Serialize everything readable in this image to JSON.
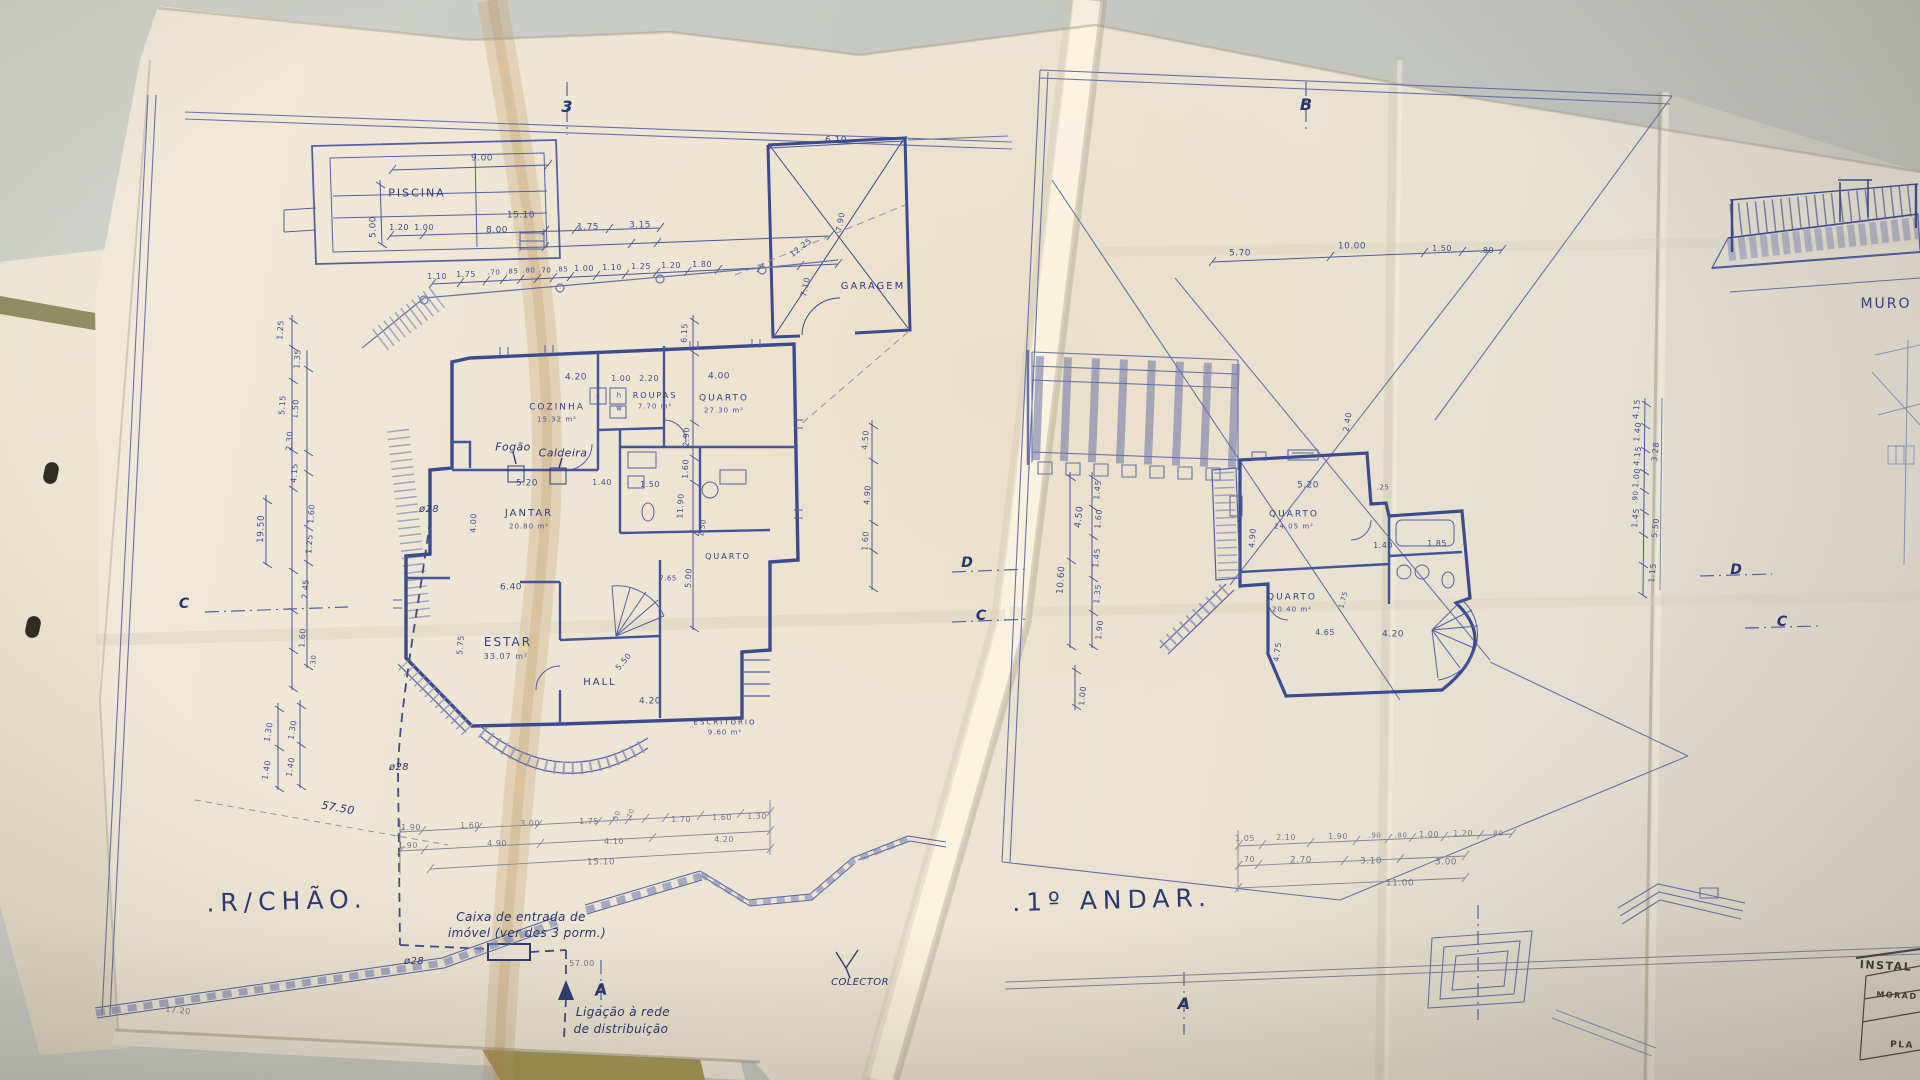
{
  "scene": {
    "desk_color": "#c7c9c4",
    "paper_color": "#ece4d4",
    "ink_color": "#3c4a8e",
    "fold_tint": "#c79a60",
    "folder_color": "#8e8e62"
  },
  "titles": {
    "ground_floor": ".R/CHÃO.",
    "first_floor": ".1º ANDAR."
  },
  "labels": [
    {
      "t": "PISCINA",
      "x": 417,
      "y": 193,
      "s": 11,
      "k": "rm"
    },
    {
      "t": "9.00",
      "x": 482,
      "y": 159,
      "s": 9,
      "k": "d"
    },
    {
      "t": "5.00",
      "x": 374,
      "y": 227,
      "s": 9,
      "k": "d",
      "r": -90
    },
    {
      "t": "1.20",
      "x": 399,
      "y": 228,
      "s": 8,
      "k": "d"
    },
    {
      "t": "1.00",
      "x": 424,
      "y": 228,
      "s": 8,
      "k": "d"
    },
    {
      "t": "15.10",
      "x": 521,
      "y": 216,
      "s": 9,
      "k": "d"
    },
    {
      "t": "8.00",
      "x": 497,
      "y": 231,
      "s": 9,
      "k": "d"
    },
    {
      "t": "1.75",
      "x": 588,
      "y": 228,
      "s": 9,
      "k": "d"
    },
    {
      "t": "3.15",
      "x": 640,
      "y": 226,
      "s": 9,
      "k": "d"
    },
    {
      "t": "1.10",
      "x": 437,
      "y": 277,
      "s": 8,
      "k": "d"
    },
    {
      "t": "1.75",
      "x": 466,
      "y": 275,
      "s": 8,
      "k": "d"
    },
    {
      "t": ".70",
      "x": 494,
      "y": 273,
      "s": 7,
      "k": "d"
    },
    {
      "t": ".85",
      "x": 512,
      "y": 272,
      "s": 7,
      "k": "d"
    },
    {
      "t": ".80",
      "x": 529,
      "y": 271,
      "s": 7,
      "k": "d"
    },
    {
      "t": ".70",
      "x": 545,
      "y": 271,
      "s": 7,
      "k": "d"
    },
    {
      "t": ".85",
      "x": 562,
      "y": 270,
      "s": 7,
      "k": "d"
    },
    {
      "t": "1.00",
      "x": 584,
      "y": 269,
      "s": 8,
      "k": "d"
    },
    {
      "t": "1.10",
      "x": 612,
      "y": 268,
      "s": 8,
      "k": "d"
    },
    {
      "t": "1.25",
      "x": 641,
      "y": 267,
      "s": 8,
      "k": "d"
    },
    {
      "t": "1.20",
      "x": 671,
      "y": 266,
      "s": 8,
      "k": "d"
    },
    {
      "t": "1.80",
      "x": 702,
      "y": 265,
      "s": 8,
      "k": "d"
    },
    {
      "t": "6.10",
      "x": 836,
      "y": 141,
      "s": 9,
      "k": "d"
    },
    {
      "t": "GARAGEM",
      "x": 873,
      "y": 287,
      "s": 10,
      "k": "rm"
    },
    {
      "t": "12.25",
      "x": 801,
      "y": 248,
      "s": 8,
      "k": "d",
      "r": -38
    },
    {
      "t": "7.90",
      "x": 841,
      "y": 222,
      "s": 8,
      "k": "d",
      "r": -80
    },
    {
      "t": "7.10",
      "x": 806,
      "y": 287,
      "s": 8,
      "k": "d",
      "r": -78
    },
    {
      "t": "4.20",
      "x": 576,
      "y": 378,
      "s": 9,
      "k": "d"
    },
    {
      "t": "1.00",
      "x": 621,
      "y": 379,
      "s": 8,
      "k": "d"
    },
    {
      "t": "2.20",
      "x": 649,
      "y": 379,
      "s": 8,
      "k": "d"
    },
    {
      "t": "4.00",
      "x": 719,
      "y": 377,
      "s": 9,
      "k": "d"
    },
    {
      "t": "COZINHA",
      "x": 557,
      "y": 408,
      "s": 9,
      "k": "rm"
    },
    {
      "t": "15.32 m²",
      "x": 557,
      "y": 420,
      "s": 7,
      "k": "a"
    },
    {
      "t": "ROUPAS",
      "x": 655,
      "y": 396,
      "s": 8,
      "k": "rm"
    },
    {
      "t": "7.70 m²",
      "x": 655,
      "y": 407,
      "s": 7,
      "k": "a"
    },
    {
      "t": "QUARTO",
      "x": 724,
      "y": 399,
      "s": 9,
      "k": "rm"
    },
    {
      "t": "27.30 m²",
      "x": 724,
      "y": 411,
      "s": 7,
      "k": "a"
    },
    {
      "t": "c",
      "x": 598,
      "y": 397,
      "s": 7,
      "k": "t"
    },
    {
      "t": "h",
      "x": 619,
      "y": 396,
      "s": 7,
      "k": "t"
    },
    {
      "t": "w",
      "x": 619,
      "y": 409,
      "s": 7,
      "k": "t"
    },
    {
      "t": "Fogão",
      "x": 513,
      "y": 447,
      "s": 11,
      "k": "s"
    },
    {
      "t": "Caldeira",
      "x": 563,
      "y": 453,
      "s": 11,
      "k": "s"
    },
    {
      "t": "ø28",
      "x": 429,
      "y": 510,
      "s": 10,
      "k": "s"
    },
    {
      "t": "5.20",
      "x": 527,
      "y": 484,
      "s": 9,
      "k": "d"
    },
    {
      "t": "1.40",
      "x": 602,
      "y": 483,
      "s": 8,
      "k": "d"
    },
    {
      "t": "1.50",
      "x": 650,
      "y": 485,
      "s": 8,
      "k": "d"
    },
    {
      "t": "JANTAR",
      "x": 529,
      "y": 514,
      "s": 10,
      "k": "rm"
    },
    {
      "t": "20.80 m²",
      "x": 529,
      "y": 527,
      "s": 7,
      "k": "a"
    },
    {
      "t": "4.00",
      "x": 474,
      "y": 523,
      "s": 8,
      "k": "d",
      "r": -88
    },
    {
      "t": "6.40",
      "x": 511,
      "y": 588,
      "s": 9,
      "k": "d"
    },
    {
      "t": "ESTAR",
      "x": 508,
      "y": 642,
      "s": 12,
      "k": "rm"
    },
    {
      "t": "33.07 m²",
      "x": 506,
      "y": 657,
      "s": 8,
      "k": "a"
    },
    {
      "t": "5.75",
      "x": 461,
      "y": 645,
      "s": 8,
      "k": "d",
      "r": -85
    },
    {
      "t": "HALL",
      "x": 600,
      "y": 683,
      "s": 10,
      "k": "rm"
    },
    {
      "t": "5.50",
      "x": 624,
      "y": 662,
      "s": 8,
      "k": "d",
      "r": -50
    },
    {
      "t": "4.20",
      "x": 650,
      "y": 702,
      "s": 9,
      "k": "d"
    },
    {
      "t": "QUARTO",
      "x": 728,
      "y": 557,
      "s": 8,
      "k": "rm"
    },
    {
      "t": "7.65",
      "x": 668,
      "y": 579,
      "s": 7,
      "k": "d"
    },
    {
      "t": "1.50",
      "x": 703,
      "y": 528,
      "s": 7,
      "k": "d",
      "r": -80
    },
    {
      "t": "ESCRITÓRIO",
      "x": 725,
      "y": 723,
      "s": 7,
      "k": "rm"
    },
    {
      "t": "9.60 m²",
      "x": 725,
      "y": 733,
      "s": 7,
      "k": "a"
    },
    {
      "t": "6.15",
      "x": 685,
      "y": 333,
      "s": 8,
      "k": "d",
      "r": -87
    },
    {
      "t": "2.90",
      "x": 687,
      "y": 437,
      "s": 8,
      "k": "d",
      "r": -87
    },
    {
      "t": "1.60",
      "x": 686,
      "y": 469,
      "s": 8,
      "k": "d",
      "r": -87
    },
    {
      "t": "11.90",
      "x": 681,
      "y": 506,
      "s": 8,
      "k": "d",
      "r": -87
    },
    {
      "t": "5.00",
      "x": 689,
      "y": 578,
      "s": 8,
      "k": "d",
      "r": -87
    },
    {
      "t": "1.25",
      "x": 281,
      "y": 330,
      "s": 8,
      "k": "d",
      "r": -86
    },
    {
      "t": "1.35",
      "x": 298,
      "y": 359,
      "s": 8,
      "k": "d",
      "r": -86
    },
    {
      "t": "5.15",
      "x": 283,
      "y": 405,
      "s": 8,
      "k": "d",
      "r": -86
    },
    {
      "t": "1.50",
      "x": 296,
      "y": 409,
      "s": 8,
      "k": "d",
      "r": -86
    },
    {
      "t": "2.30",
      "x": 290,
      "y": 441,
      "s": 8,
      "k": "d",
      "r": -86
    },
    {
      "t": "4.15",
      "x": 295,
      "y": 473,
      "s": 8,
      "k": "d",
      "r": -86
    },
    {
      "t": "1.60",
      "x": 312,
      "y": 514,
      "s": 8,
      "k": "d",
      "r": -86
    },
    {
      "t": "1.25",
      "x": 310,
      "y": 544,
      "s": 8,
      "k": "d",
      "r": -86
    },
    {
      "t": "2.45",
      "x": 306,
      "y": 589,
      "s": 8,
      "k": "d",
      "r": -86
    },
    {
      "t": "1.60",
      "x": 303,
      "y": 638,
      "s": 8,
      "k": "d",
      "r": -86
    },
    {
      "t": ".30",
      "x": 314,
      "y": 661,
      "s": 7,
      "k": "d",
      "r": -86
    },
    {
      "t": "19.50",
      "x": 262,
      "y": 529,
      "s": 9,
      "k": "d",
      "r": -88
    },
    {
      "t": "1.30",
      "x": 269,
      "y": 732,
      "s": 8,
      "k": "d",
      "r": -80
    },
    {
      "t": "1.30",
      "x": 293,
      "y": 730,
      "s": 8,
      "k": "d",
      "r": -80
    },
    {
      "t": "1.40",
      "x": 267,
      "y": 770,
      "s": 8,
      "k": "d",
      "r": -80
    },
    {
      "t": "1.40",
      "x": 291,
      "y": 767,
      "s": 8,
      "k": "d",
      "r": -80
    },
    {
      "t": "57.50",
      "x": 338,
      "y": 808,
      "s": 11,
      "k": "s",
      "r": 10
    },
    {
      "t": "ø28",
      "x": 399,
      "y": 768,
      "s": 10,
      "k": "s"
    },
    {
      "t": "1.90",
      "x": 411,
      "y": 828,
      "s": 8,
      "k": "p"
    },
    {
      "t": "1.60",
      "x": 470,
      "y": 826,
      "s": 8,
      "k": "p"
    },
    {
      "t": "3.00",
      "x": 530,
      "y": 824,
      "s": 8,
      "k": "p"
    },
    {
      "t": "1.75",
      "x": 589,
      "y": 822,
      "s": 8,
      "k": "p"
    },
    {
      "t": ".50",
      "x": 617,
      "y": 817,
      "s": 7,
      "k": "p",
      "r": -70
    },
    {
      "t": ".70",
      "x": 631,
      "y": 815,
      "s": 7,
      "k": "p",
      "r": -70
    },
    {
      "t": "1.70",
      "x": 681,
      "y": 820,
      "s": 8,
      "k": "p"
    },
    {
      "t": "1.60",
      "x": 722,
      "y": 818,
      "s": 8,
      "k": "p"
    },
    {
      "t": "1.30",
      "x": 757,
      "y": 817,
      "s": 8,
      "k": "p"
    },
    {
      "t": "1.90",
      "x": 408,
      "y": 846,
      "s": 8,
      "k": "p"
    },
    {
      "t": "4.90",
      "x": 497,
      "y": 844,
      "s": 8,
      "k": "p"
    },
    {
      "t": "4.10",
      "x": 614,
      "y": 842,
      "s": 8,
      "k": "p"
    },
    {
      "t": "4.20",
      "x": 724,
      "y": 840,
      "s": 8,
      "k": "p"
    },
    {
      "t": "15.10",
      "x": 601,
      "y": 863,
      "s": 9,
      "k": "p"
    },
    {
      "t": "ø28",
      "x": 414,
      "y": 962,
      "s": 10,
      "k": "s"
    },
    {
      "t": "Caixa de entrada de",
      "x": 521,
      "y": 917,
      "s": 12,
      "k": "s"
    },
    {
      "t": "imóvel (ver des 3 porm.)",
      "x": 527,
      "y": 933,
      "s": 12,
      "k": "s"
    },
    {
      "t": "57.00",
      "x": 582,
      "y": 964,
      "s": 8,
      "k": "p"
    },
    {
      "t": "Ligação à rede",
      "x": 623,
      "y": 1012,
      "s": 12,
      "k": "s"
    },
    {
      "t": "de distribuição",
      "x": 621,
      "y": 1029,
      "s": 12,
      "k": "s"
    },
    {
      "t": "COLECTOR",
      "x": 860,
      "y": 983,
      "s": 10,
      "k": "s"
    },
    {
      "t": "17.20",
      "x": 178,
      "y": 1011,
      "s": 8,
      "k": "p",
      "r": 6
    },
    {
      "t": "3",
      "x": 567,
      "y": 107,
      "s": 16,
      "k": "m"
    },
    {
      "t": "A",
      "x": 601,
      "y": 990,
      "s": 16,
      "k": "m",
      "r": -6
    },
    {
      "t": "C",
      "x": 184,
      "y": 604,
      "s": 14,
      "k": "m"
    },
    {
      "t": "D",
      "x": 967,
      "y": 563,
      "s": 14,
      "k": "m"
    },
    {
      "t": "C",
      "x": 981,
      "y": 616,
      "s": 14,
      "k": "m"
    },
    {
      "t": "4.50",
      "x": 866,
      "y": 440,
      "s": 8,
      "k": "d",
      "r": -86
    },
    {
      "t": "4.90",
      "x": 868,
      "y": 495,
      "s": 8,
      "k": "d",
      "r": -86
    },
    {
      "t": "1.60",
      "x": 866,
      "y": 541,
      "s": 8,
      "k": "d",
      "r": -86
    },
    {
      "t": "B",
      "x": 1306,
      "y": 105,
      "s": 16,
      "k": "m"
    },
    {
      "t": "5.70",
      "x": 1240,
      "y": 254,
      "s": 9,
      "k": "d"
    },
    {
      "t": "10.00",
      "x": 1352,
      "y": 247,
      "s": 9,
      "k": "d"
    },
    {
      "t": "1.50",
      "x": 1442,
      "y": 249,
      "s": 8,
      "k": "d"
    },
    {
      "t": ".80",
      "x": 1487,
      "y": 251,
      "s": 8,
      "k": "d"
    },
    {
      "t": "1.45",
      "x": 1098,
      "y": 490,
      "s": 8,
      "k": "d",
      "r": -84
    },
    {
      "t": "1.60",
      "x": 1099,
      "y": 519,
      "s": 8,
      "k": "d",
      "r": -84
    },
    {
      "t": "1.45",
      "x": 1097,
      "y": 558,
      "s": 8,
      "k": "d",
      "r": -84
    },
    {
      "t": "1.35",
      "x": 1098,
      "y": 594,
      "s": 8,
      "k": "d",
      "r": -84
    },
    {
      "t": "1.90",
      "x": 1100,
      "y": 630,
      "s": 8,
      "k": "d",
      "r": -84
    },
    {
      "t": "4.50",
      "x": 1080,
      "y": 517,
      "s": 9,
      "k": "d",
      "r": -84
    },
    {
      "t": "10.60",
      "x": 1062,
      "y": 580,
      "s": 9,
      "k": "d",
      "r": -86
    },
    {
      "t": "1.00",
      "x": 1083,
      "y": 696,
      "s": 8,
      "k": "d",
      "r": -84
    },
    {
      "t": "QUARTO",
      "x": 1294,
      "y": 515,
      "s": 9,
      "k": "rm"
    },
    {
      "t": "24.05 m²",
      "x": 1294,
      "y": 527,
      "s": 7,
      "k": "a"
    },
    {
      "t": "5.20",
      "x": 1308,
      "y": 486,
      "s": 9,
      "k": "d"
    },
    {
      "t": ".25",
      "x": 1383,
      "y": 488,
      "s": 7,
      "k": "d"
    },
    {
      "t": "4.90",
      "x": 1253,
      "y": 538,
      "s": 8,
      "k": "d",
      "r": -85
    },
    {
      "t": "QUARTO",
      "x": 1292,
      "y": 598,
      "s": 9,
      "k": "rm"
    },
    {
      "t": "20.40 m²",
      "x": 1292,
      "y": 610,
      "s": 7,
      "k": "a"
    },
    {
      "t": "1.40",
      "x": 1383,
      "y": 546,
      "s": 8,
      "k": "d"
    },
    {
      "t": "1.85",
      "x": 1437,
      "y": 544,
      "s": 8,
      "k": "d"
    },
    {
      "t": "4.65",
      "x": 1325,
      "y": 633,
      "s": 8,
      "k": "d"
    },
    {
      "t": "4.20",
      "x": 1393,
      "y": 635,
      "s": 9,
      "k": "d"
    },
    {
      "t": "4.75",
      "x": 1278,
      "y": 652,
      "s": 8,
      "k": "d",
      "r": -82
    },
    {
      "t": "1.75",
      "x": 1344,
      "y": 600,
      "s": 7,
      "k": "d",
      "r": -75
    },
    {
      "t": "2.40",
      "x": 1348,
      "y": 422,
      "s": 8,
      "k": "d",
      "r": -80
    },
    {
      "t": "1.05",
      "x": 1245,
      "y": 839,
      "s": 8,
      "k": "p"
    },
    {
      "t": "2.10",
      "x": 1286,
      "y": 838,
      "s": 8,
      "k": "p"
    },
    {
      "t": "1.90",
      "x": 1338,
      "y": 837,
      "s": 8,
      "k": "p"
    },
    {
      "t": ".90",
      "x": 1375,
      "y": 836,
      "s": 7,
      "k": "p"
    },
    {
      "t": ".80",
      "x": 1401,
      "y": 836,
      "s": 7,
      "k": "p"
    },
    {
      "t": "1.00",
      "x": 1429,
      "y": 835,
      "s": 8,
      "k": "p"
    },
    {
      "t": "1.20",
      "x": 1463,
      "y": 834,
      "s": 8,
      "k": "p"
    },
    {
      "t": ".80",
      "x": 1497,
      "y": 834,
      "s": 7,
      "k": "p"
    },
    {
      "t": ".70",
      "x": 1248,
      "y": 860,
      "s": 8,
      "k": "p"
    },
    {
      "t": "2.70",
      "x": 1301,
      "y": 861,
      "s": 9,
      "k": "p"
    },
    {
      "t": "3.10",
      "x": 1371,
      "y": 862,
      "s": 9,
      "k": "p"
    },
    {
      "t": "3.00",
      "x": 1446,
      "y": 863,
      "s": 9,
      "k": "p"
    },
    {
      "t": "11.00",
      "x": 1400,
      "y": 884,
      "s": 9,
      "k": "p"
    },
    {
      "t": "A",
      "x": 1184,
      "y": 1004,
      "s": 16,
      "k": "m"
    },
    {
      "t": "4.15",
      "x": 1637,
      "y": 409,
      "s": 8,
      "k": "d",
      "r": -84
    },
    {
      "t": "1.40",
      "x": 1638,
      "y": 432,
      "s": 8,
      "k": "d",
      "r": -84
    },
    {
      "t": "4.15",
      "x": 1638,
      "y": 456,
      "s": 8,
      "k": "d",
      "r": -84
    },
    {
      "t": "1.00",
      "x": 1637,
      "y": 478,
      "s": 8,
      "k": "d",
      "r": -84
    },
    {
      "t": ".90",
      "x": 1636,
      "y": 497,
      "s": 7,
      "k": "d",
      "r": -84
    },
    {
      "t": "1.45",
      "x": 1636,
      "y": 518,
      "s": 8,
      "k": "d",
      "r": -84
    },
    {
      "t": "3.28",
      "x": 1656,
      "y": 452,
      "s": 8,
      "k": "d",
      "r": -84
    },
    {
      "t": "5.50",
      "x": 1656,
      "y": 528,
      "s": 8,
      "k": "d",
      "r": -84
    },
    {
      "t": "1.15",
      "x": 1653,
      "y": 573,
      "s": 8,
      "k": "d",
      "r": -84
    },
    {
      "t": "D",
      "x": 1736,
      "y": 570,
      "s": 14,
      "k": "m"
    },
    {
      "t": "C",
      "x": 1782,
      "y": 622,
      "s": 14,
      "k": "m"
    },
    {
      "t": "MURO",
      "x": 1886,
      "y": 304,
      "s": 14,
      "k": "rm"
    },
    {
      "t": "INSTAL",
      "x": 1886,
      "y": 966,
      "s": 11,
      "k": "tb",
      "r": 3
    },
    {
      "t": "MORAD",
      "x": 1897,
      "y": 996,
      "s": 8,
      "k": "tb",
      "r": 3
    },
    {
      "t": "PLA",
      "x": 1902,
      "y": 1046,
      "s": 9,
      "k": "tb",
      "r": 3
    }
  ]
}
